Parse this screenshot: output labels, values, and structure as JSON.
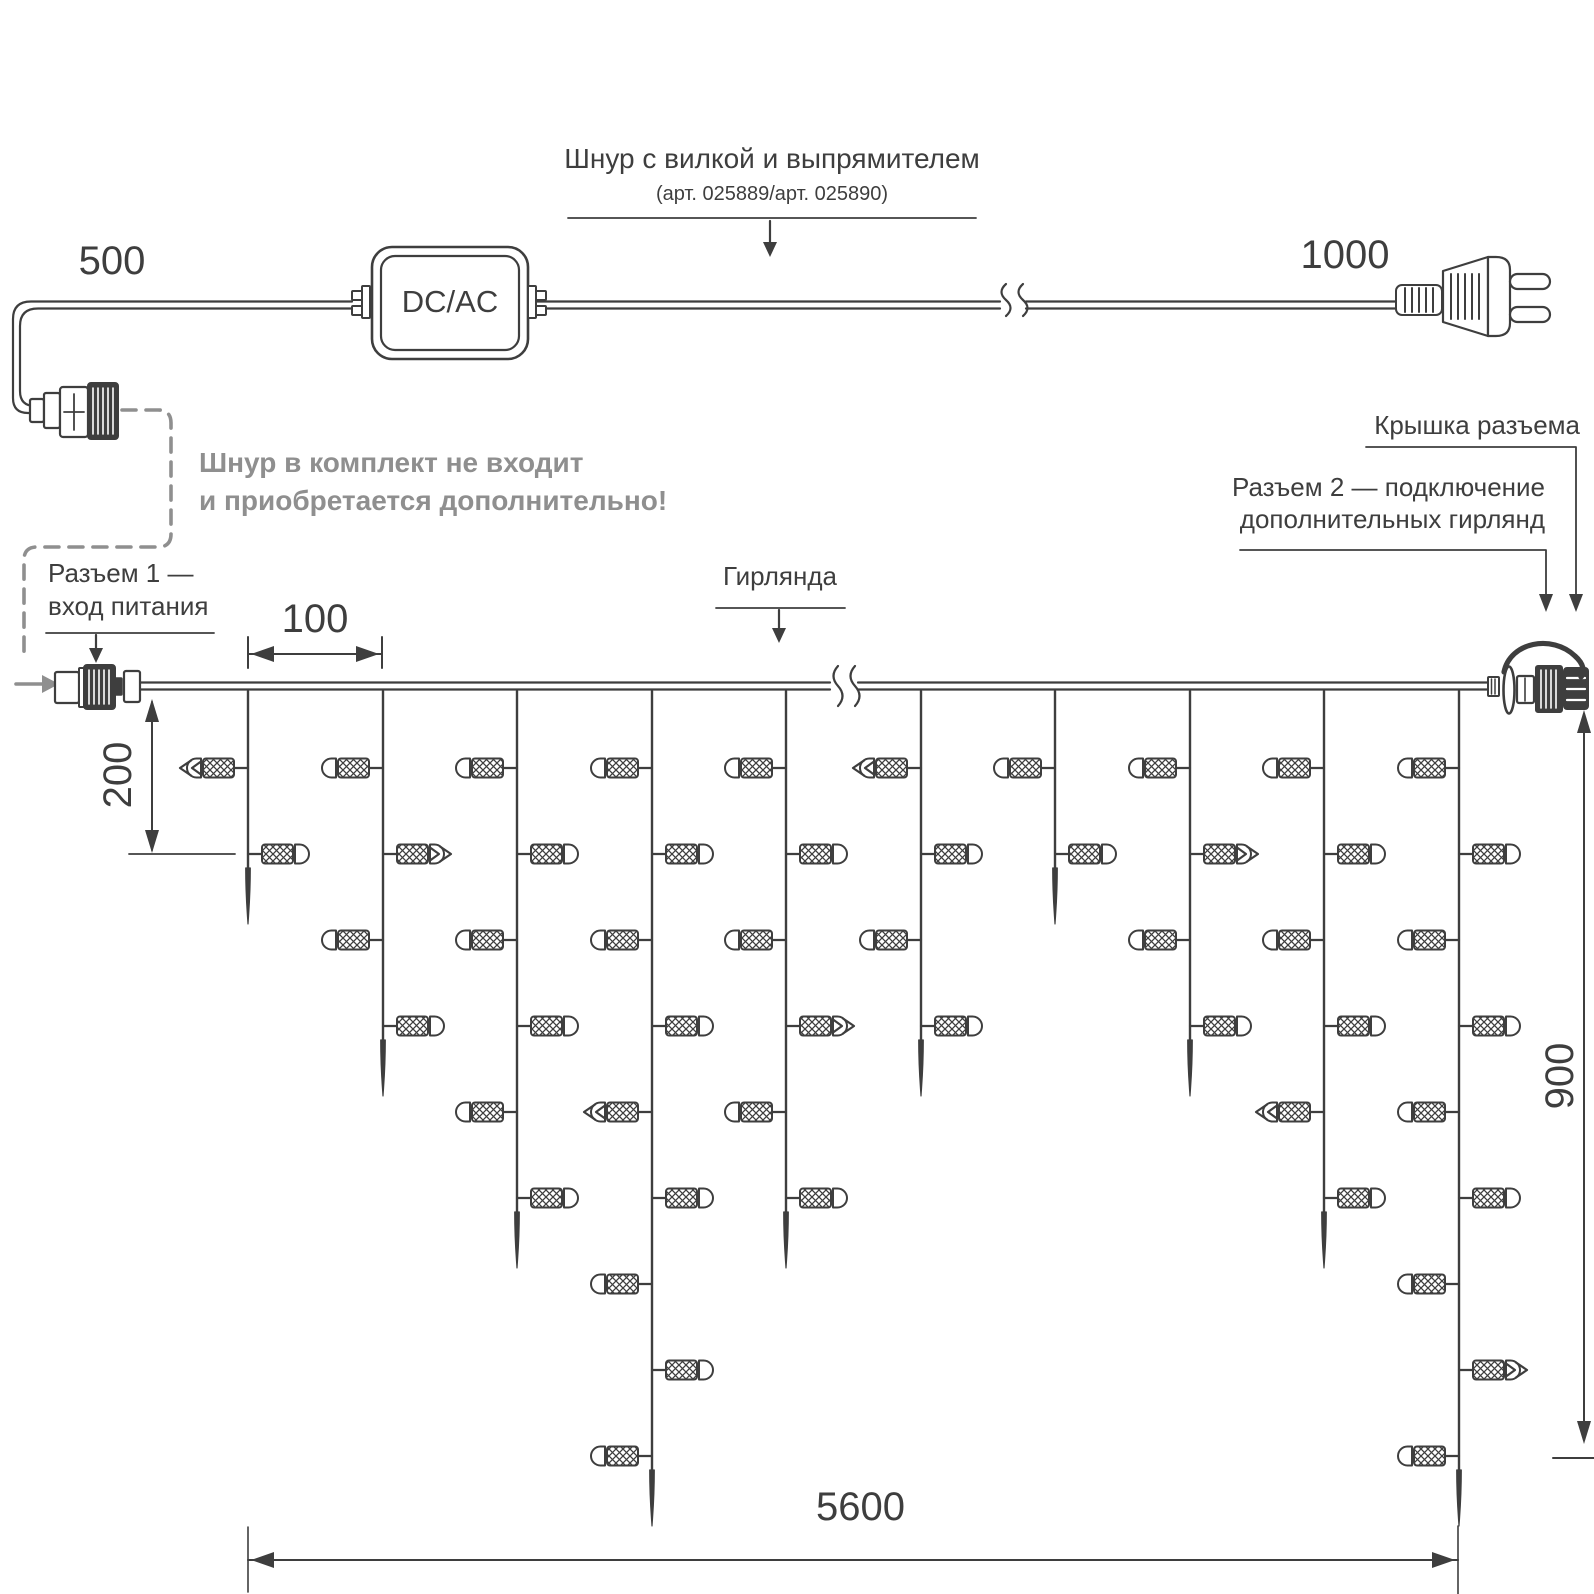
{
  "colors": {
    "ink": "#3e3e3e",
    "gray": "#8f8f8f",
    "bg": "#ffffff"
  },
  "labels": {
    "cord_title": "Шнур с вилкой и выпрямителем",
    "cord_articles": "(арт. 025889/арт. 025890)",
    "dim_500": "500",
    "dim_1000": "1000",
    "converter": "DC/AC",
    "note_line1": "Шнур в комплект не входит",
    "note_line2": "и приобретается дополнительно!",
    "connector1_line1": "Разъем 1 —",
    "connector1_line2": "вход питания",
    "garland": "Гирлянда",
    "cap": "Крышка разъема",
    "connector2_line1": "Разъем 2 — подключение",
    "connector2_line2": "дополнительных гирлянд",
    "dim_100": "100",
    "dim_200": "200",
    "dim_900": "900",
    "dim_5600": "5600"
  },
  "garland": {
    "drop_count": 10,
    "bulbs_per_drop": [
      2,
      4,
      6,
      9,
      6,
      4,
      2,
      4,
      6,
      9
    ],
    "first_bulb_side": "left",
    "arrow_marks": [
      {
        "drop": 1,
        "bulb": 1
      },
      {
        "drop": 2,
        "bulb": 2
      },
      {
        "drop": 4,
        "bulb": 5
      },
      {
        "drop": 5,
        "bulb": 4
      },
      {
        "drop": 6,
        "bulb": 1
      },
      {
        "drop": 8,
        "bulb": 2
      },
      {
        "drop": 9,
        "bulb": 5
      },
      {
        "drop": 10,
        "bulb": 8
      }
    ]
  }
}
